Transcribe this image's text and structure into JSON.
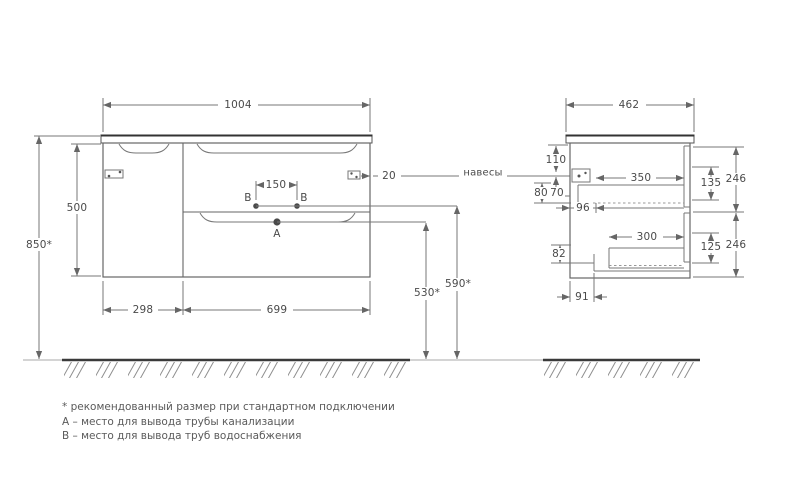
{
  "front": {
    "width": "1004",
    "height": "500",
    "mount_height": "850*",
    "door_width": "298",
    "drawer_width": "699",
    "hanger_inset": "20",
    "outlet_spacing": "150",
    "drain_outlet_height": "530*",
    "supply_outlet_height": "590*",
    "label_a": "A",
    "label_b_left": "B",
    "label_b_right": "B"
  },
  "side": {
    "depth": "462",
    "top_offset": "110",
    "offset_80": "80",
    "offset_70": "70",
    "hanger_depth": "96",
    "drawer1_inner_depth": "350",
    "drawer1_front_opening": "135",
    "drawer1_front_height": "246",
    "drawer2_inner_depth": "300",
    "drawer2_front_opening": "125",
    "drawer2_front_height": "246",
    "notch_height": "82",
    "notch_depth": "91"
  },
  "callouts": {
    "hangers": "навесы"
  },
  "notes": {
    "line1": "* рекомендованный размер при стандартном подключении",
    "line2": "А – место для вывода трубы канализации",
    "line3": "В – место для вывода труб водоснабжения"
  }
}
